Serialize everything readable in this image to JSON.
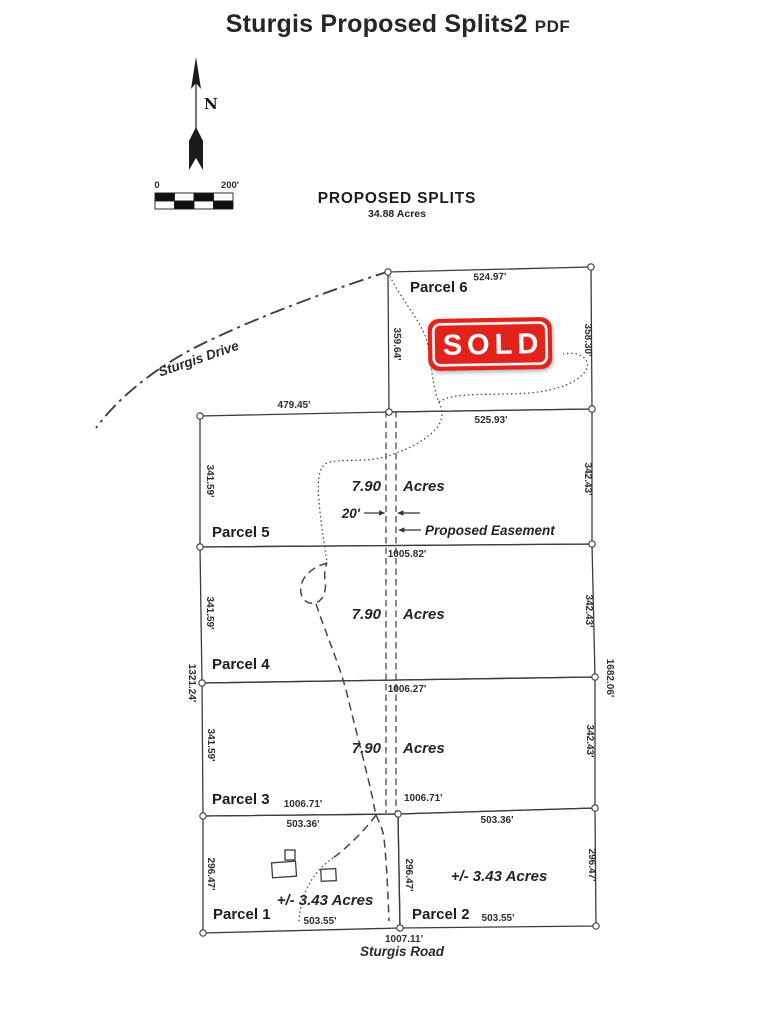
{
  "title": {
    "text": "Sturgis Proposed Splits2",
    "badge": "PDF"
  },
  "compass": {
    "north": "N"
  },
  "scale_bar": {
    "start": "0",
    "end": "200'"
  },
  "heading": {
    "title": "PROPOSED SPLITS",
    "total_area": "34.88 Acres"
  },
  "roads": {
    "drive": "Sturgis Drive",
    "road": "Sturgis Road"
  },
  "overall_dims": {
    "west": "1321.24'",
    "east": "1682.06'",
    "south": "1007.11'"
  },
  "easement": {
    "width": "20'",
    "label": "Proposed Easement"
  },
  "sold_stamp": {
    "label": "SOLD",
    "color": "#e2231d"
  },
  "parcels": {
    "p6": {
      "name": "Parcel 6",
      "north": "524.97'",
      "west": "359.64'",
      "east": "358.30'"
    },
    "p5": {
      "name": "Parcel 5",
      "north_west": "479.45'",
      "north_east": "525.93'",
      "west": "341.59'",
      "east": "342.43'",
      "area_value": "7.90",
      "area_unit": "Acres",
      "south": "1005.82'"
    },
    "p4": {
      "name": "Parcel 4",
      "west": "341.59'",
      "east": "342.43'",
      "area_value": "7.90",
      "area_unit": "Acres",
      "south": "1006.27'"
    },
    "p3": {
      "name": "Parcel 3",
      "west": "341.59'",
      "east": "342.43'",
      "area_value": "7.90",
      "area_unit": "Acres",
      "south_west": "1006.71'",
      "south_east": "1006.71'"
    },
    "p1": {
      "name": "Parcel 1",
      "north": "503.36'",
      "west": "296.47'",
      "east_shared": "296.47'",
      "area": "+/- 3.43 Acres",
      "south": "503.55'"
    },
    "p2": {
      "name": "Parcel 2",
      "north": "503.36'",
      "east": "296.47'",
      "area": "+/- 3.43 Acres",
      "south": "503.55'"
    }
  }
}
